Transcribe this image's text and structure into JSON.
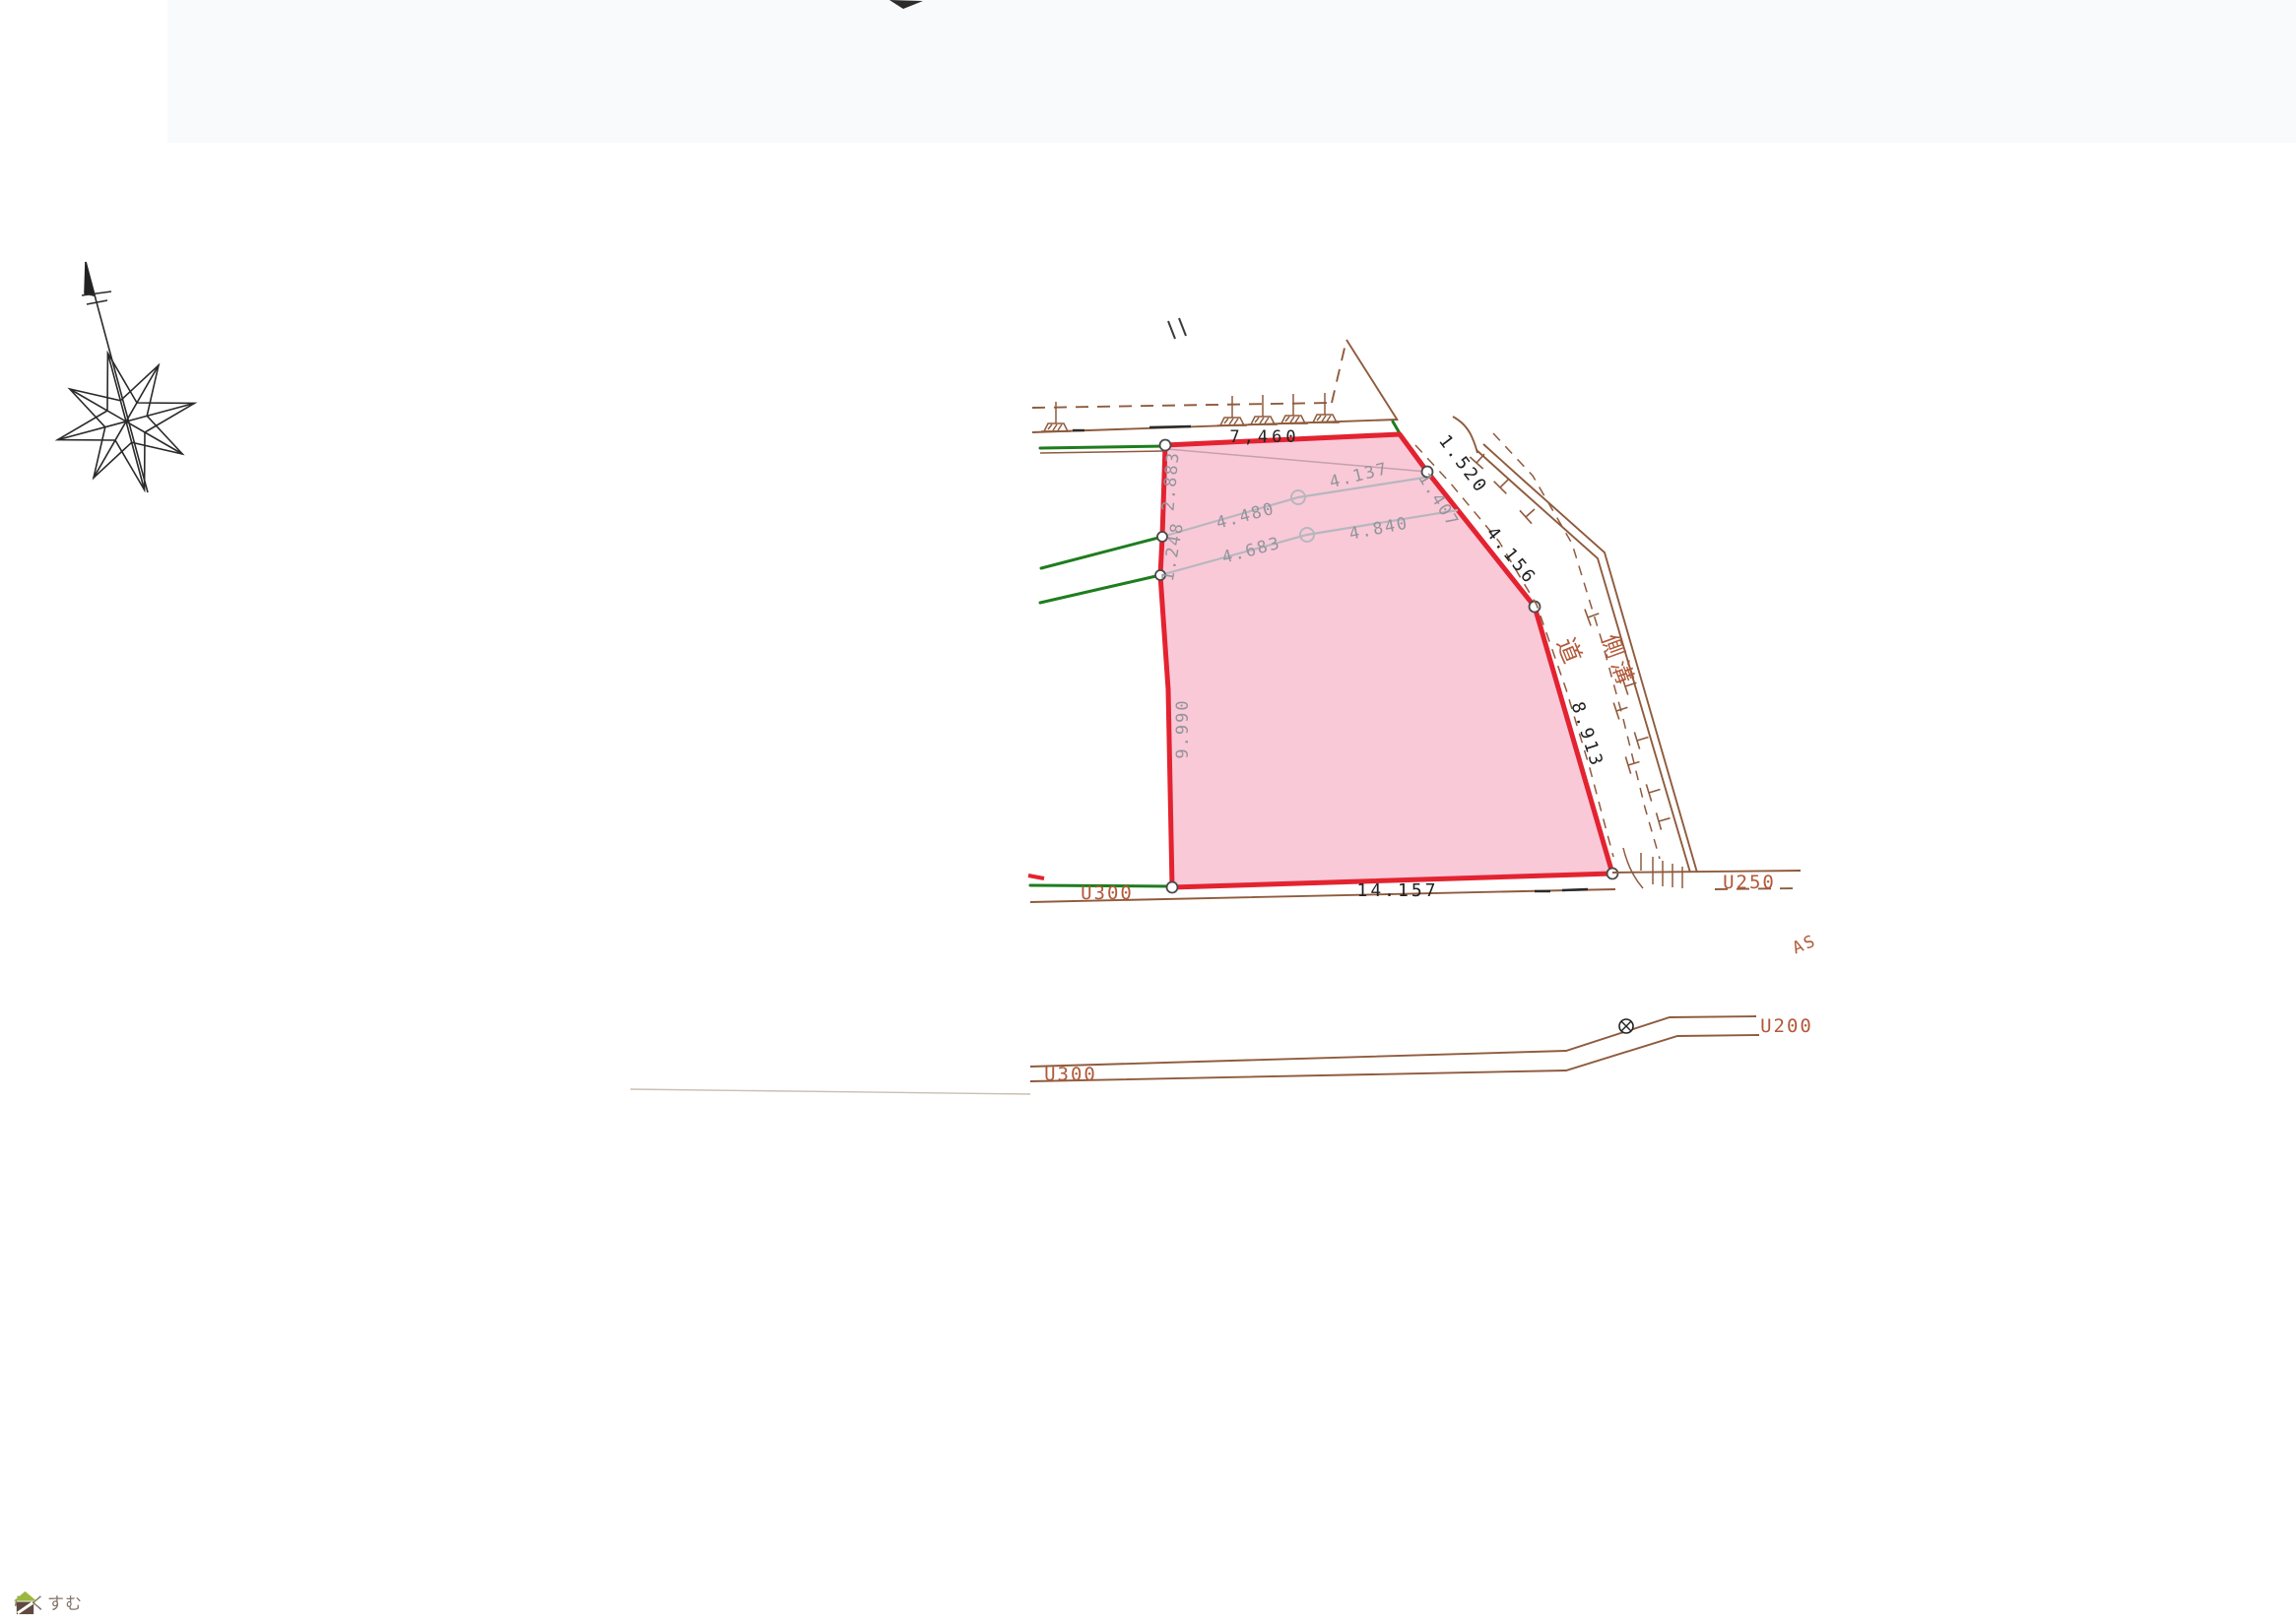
{
  "labels": {
    "dim_top": "7,460",
    "dim_top_right": "1.520",
    "dim_right_upper": "4.156",
    "dim_right_lower": "8.913",
    "dim_bottom": "14.157",
    "dim_left": "9.990",
    "seg_left_upper": "2.883",
    "seg_left_lower": "1.248",
    "pipe1_left": "4.480",
    "pipe1_right": "4.137",
    "pipe2_left": "4.683",
    "pipe2_right": "4.840",
    "pipe_edge": "1.407",
    "road_kanji": "道",
    "gutter_kanji": "側溝",
    "u300_top": "U300",
    "u250": "U250",
    "as_surface": "AS",
    "u200": "U200",
    "u300_bottom": "U300"
  },
  "watermark": {
    "text": "らくすむ"
  },
  "colors": {
    "red": "#e32330",
    "pink": "#f9c9d8",
    "brown": "#8f5b3d",
    "brown_text": "#b2593a",
    "green": "#1e7d1e",
    "gray_line": "#b7b7bd",
    "gray_text": "#94949c",
    "black": "#222222",
    "paper": "#ffffff"
  }
}
